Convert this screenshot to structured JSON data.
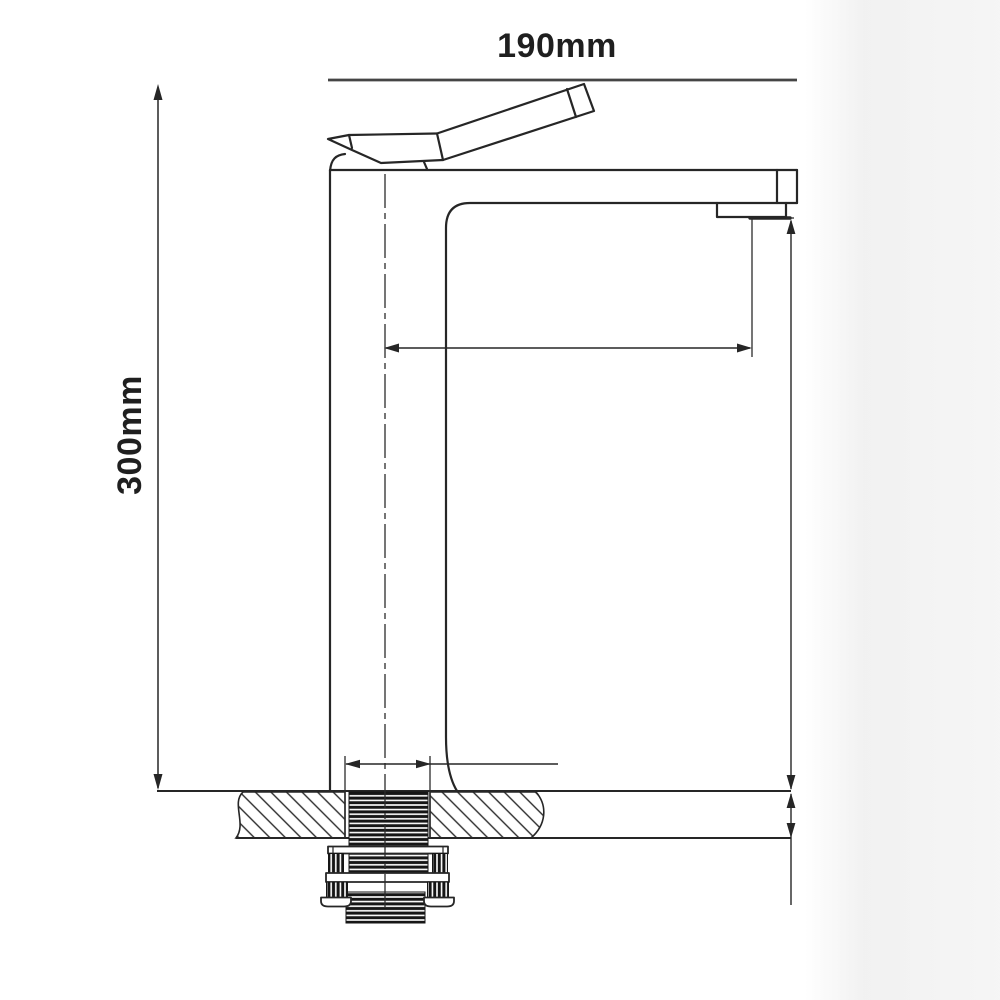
{
  "drawing": {
    "kind": "technical-drawing",
    "subject": "tall single-lever basin mixer tap, side elevation with mounting cross-section",
    "width_label": "190mm",
    "height_label": "300mm",
    "colors": {
      "line": "#262626",
      "dimension_line": "#3f3f3f",
      "background": "#ffffff",
      "thread_fill": "#161616"
    }
  }
}
